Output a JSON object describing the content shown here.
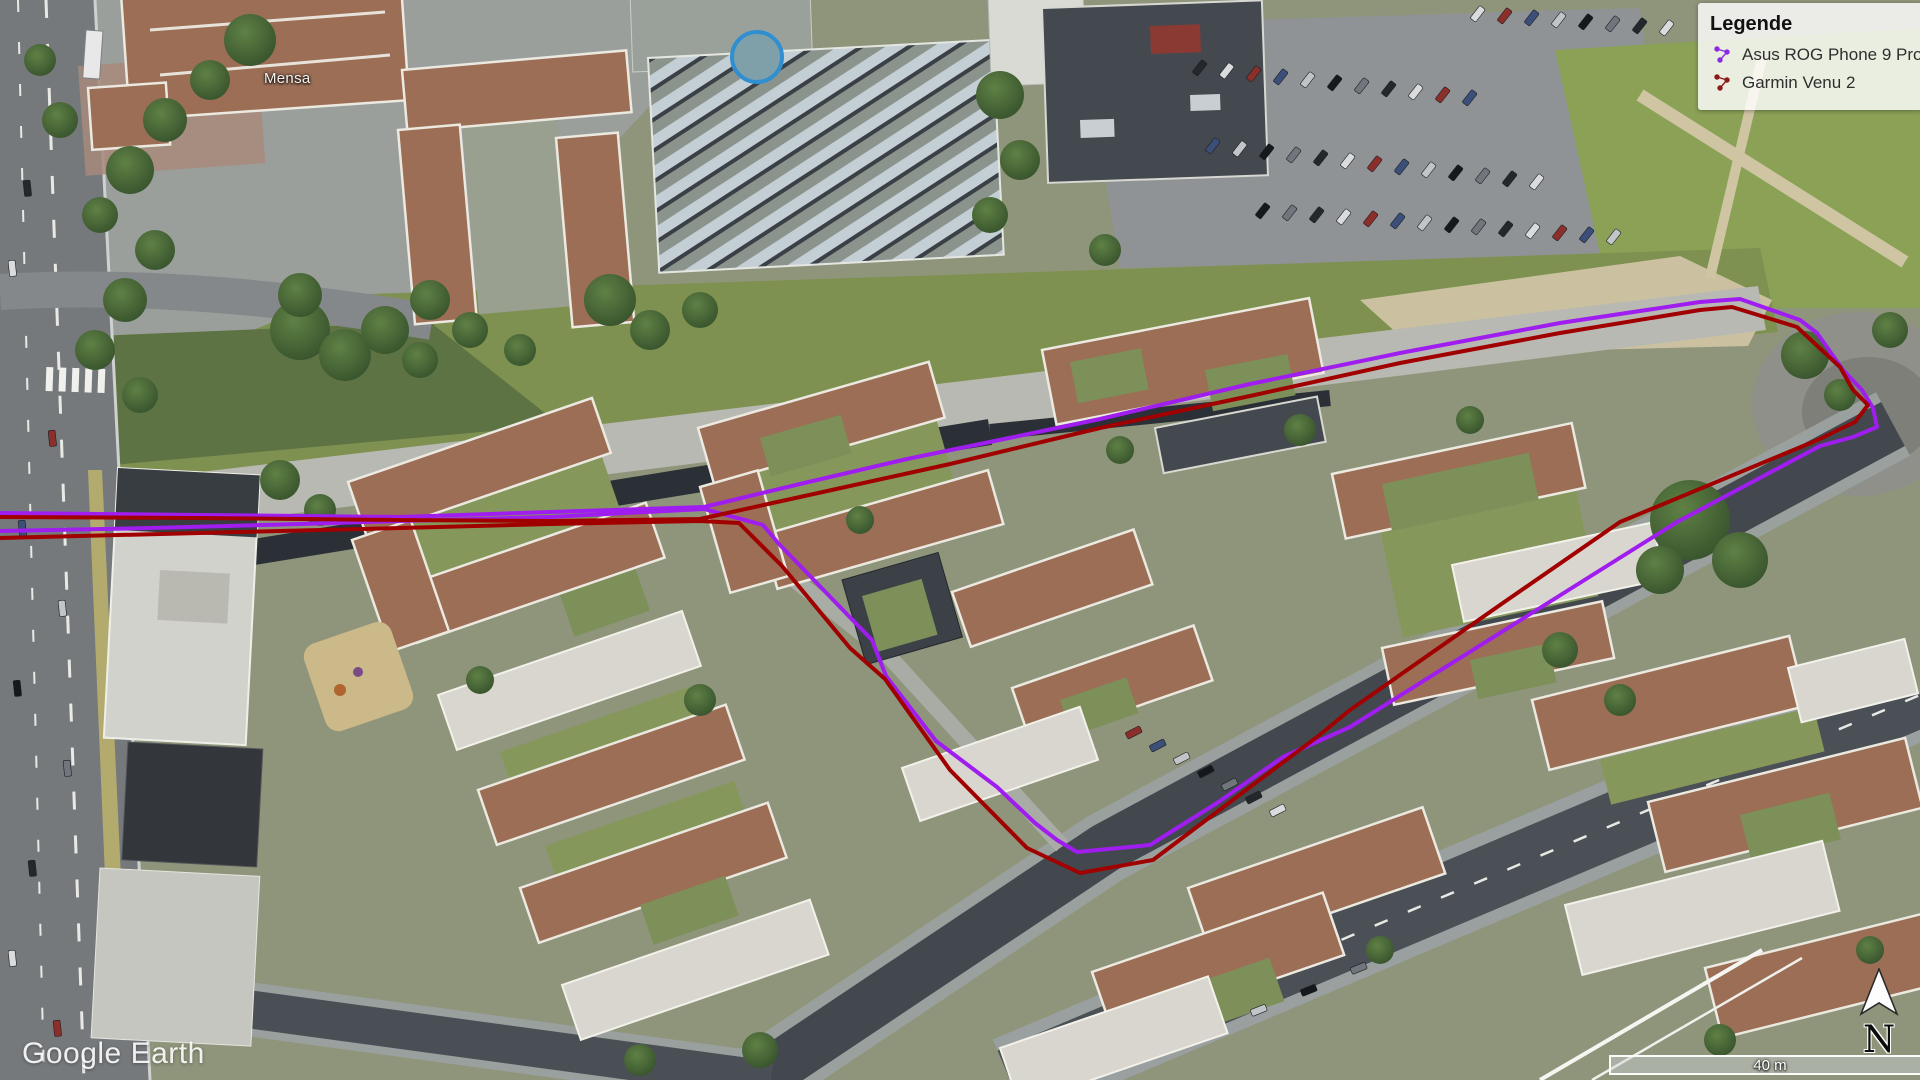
{
  "legend": {
    "title": "Legende",
    "items": [
      {
        "label": "Asus ROG Phone 9 Pro",
        "color": "#8a2be2"
      },
      {
        "label": "Garmin Venu 2",
        "color": "#8b1a1a"
      }
    ]
  },
  "map": {
    "watermark": "Google Earth",
    "place_label": "Mensa",
    "scale_label": "40 m",
    "north_label": "N"
  },
  "tracks": [
    {
      "name": "Asus ROG Phone 9 Pro",
      "color": "#a01df0",
      "width": 4,
      "points": [
        [
          0,
          513
        ],
        [
          200,
          515
        ],
        [
          400,
          517
        ],
        [
          550,
          512
        ],
        [
          704,
          507
        ],
        [
          800,
          484
        ],
        [
          907,
          459
        ],
        [
          1014,
          437
        ],
        [
          1100,
          419
        ],
        [
          1250,
          384
        ],
        [
          1400,
          353
        ],
        [
          1560,
          323
        ],
        [
          1700,
          302
        ],
        [
          1740,
          299
        ],
        [
          1800,
          320
        ],
        [
          1817,
          333
        ],
        [
          1843,
          370
        ],
        [
          1862,
          390
        ],
        [
          1873,
          408
        ],
        [
          1877,
          427
        ],
        [
          1853,
          437
        ],
        [
          1820,
          446
        ],
        [
          1677,
          522
        ],
        [
          1500,
          633
        ],
        [
          1350,
          727
        ],
        [
          1283,
          757
        ],
        [
          1217,
          803
        ],
        [
          1150,
          845
        ],
        [
          1077,
          852
        ],
        [
          1057,
          840
        ],
        [
          1035,
          823
        ],
        [
          997,
          787
        ],
        [
          936,
          741
        ],
        [
          886,
          676
        ],
        [
          872,
          640
        ],
        [
          779,
          544
        ],
        [
          763,
          525
        ],
        [
          704,
          509
        ],
        [
          550,
          517
        ],
        [
          400,
          521
        ],
        [
          300,
          524
        ],
        [
          150,
          528
        ],
        [
          0,
          531
        ]
      ]
    },
    {
      "name": "Garmin Venu 2",
      "color": "#a00000",
      "width": 4,
      "points": [
        [
          0,
          517
        ],
        [
          200,
          518
        ],
        [
          400,
          520
        ],
        [
          550,
          521
        ],
        [
          700,
          519
        ],
        [
          800,
          497
        ],
        [
          950,
          464
        ],
        [
          1100,
          428
        ],
        [
          1250,
          396
        ],
        [
          1400,
          363
        ],
        [
          1560,
          333
        ],
        [
          1700,
          310
        ],
        [
          1732,
          307
        ],
        [
          1797,
          327
        ],
        [
          1840,
          367
        ],
        [
          1853,
          390
        ],
        [
          1868,
          405
        ],
        [
          1855,
          422
        ],
        [
          1838,
          430
        ],
        [
          1820,
          439
        ],
        [
          1620,
          522
        ],
        [
          1500,
          605
        ],
        [
          1350,
          710
        ],
        [
          1317,
          737
        ],
        [
          1250,
          787
        ],
        [
          1153,
          860
        ],
        [
          1080,
          873
        ],
        [
          1027,
          848
        ],
        [
          950,
          770
        ],
        [
          885,
          679
        ],
        [
          850,
          648
        ],
        [
          782,
          566
        ],
        [
          739,
          523
        ],
        [
          700,
          521
        ],
        [
          550,
          524
        ],
        [
          400,
          528
        ],
        [
          200,
          533
        ],
        [
          0,
          538
        ]
      ]
    }
  ]
}
